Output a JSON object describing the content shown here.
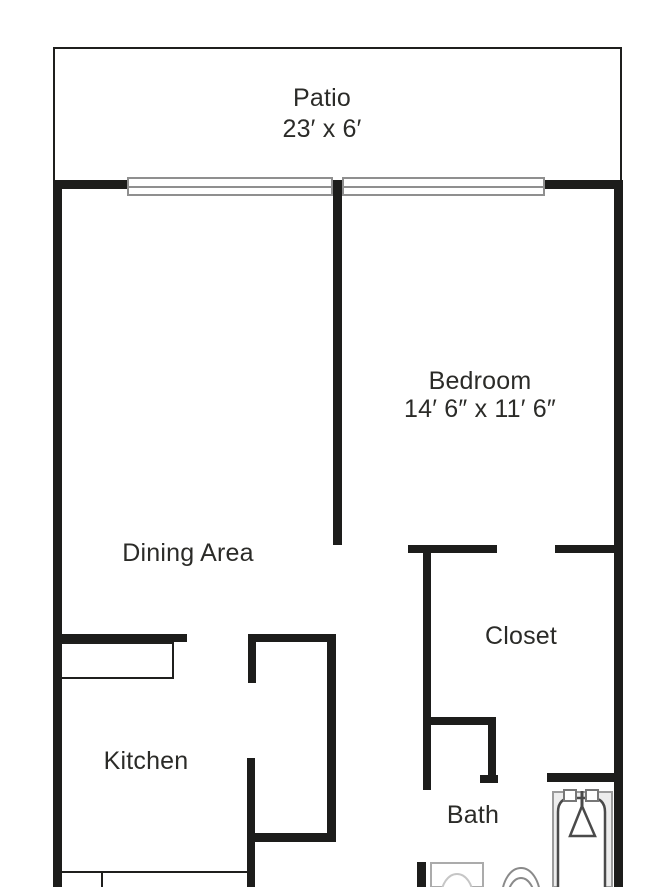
{
  "title": "Apartment floor plan",
  "rooms": {
    "patio": {
      "name": "Patio",
      "dims": "23′ x 6′"
    },
    "bedroom": {
      "name": "Bedroom",
      "dims": "14′ 6″ x 11′ 6″"
    },
    "dining": {
      "name": "Dining Area"
    },
    "closet": {
      "name": "Closet"
    },
    "kitchen": {
      "name": "Kitchen"
    },
    "bath": {
      "name": "Bath"
    }
  },
  "fixtures": {
    "sliding_doors": 2,
    "items": [
      "sliding-door",
      "sliding-door",
      "dining-counter",
      "kitchen-counter",
      "bathtub-with-shower",
      "sink-vanity",
      "toilet"
    ]
  },
  "colors": {
    "wall": "#1d1d1b",
    "label_text": "#2b2b28",
    "door_outline": "#8f8f8f",
    "fixture_outline": "#9b9b9b",
    "tub_fill": "#ededed"
  }
}
